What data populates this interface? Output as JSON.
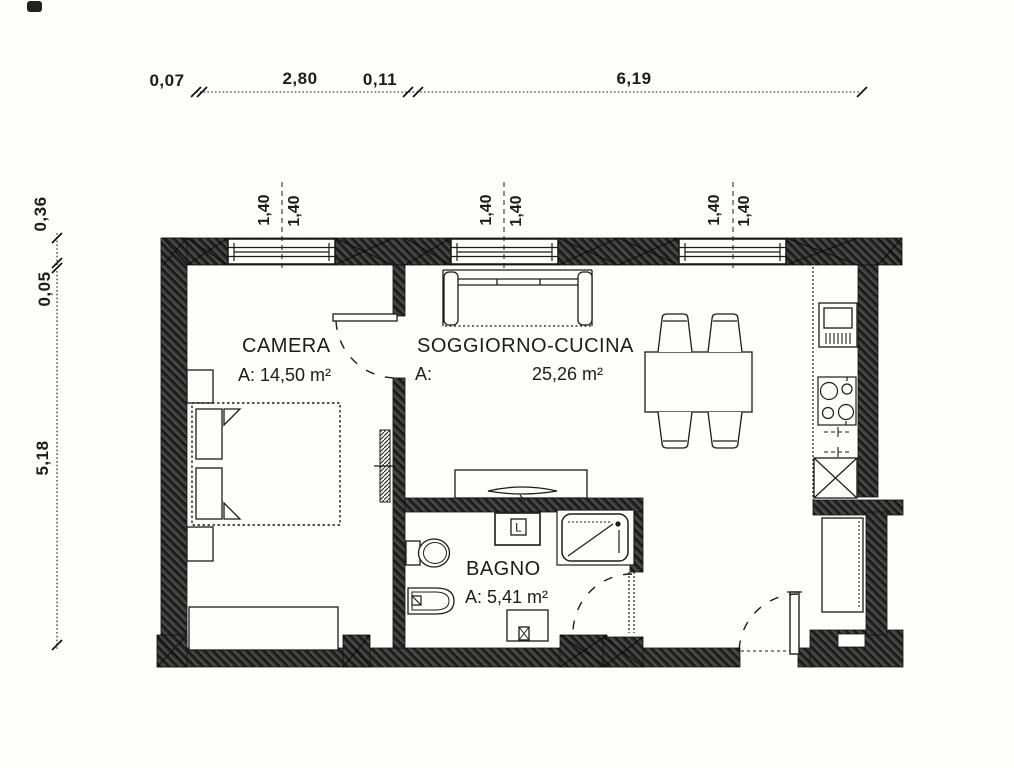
{
  "dims": {
    "top": {
      "d1": "0,07",
      "d2": "2,80",
      "d3": "0,11",
      "d4": "6,19"
    },
    "left": {
      "d1": "0,36",
      "d2": "0,05",
      "d3": "5,18"
    },
    "win1a": "1,40",
    "win1b": "1,40",
    "win2a": "1,40",
    "win2b": "1,40",
    "win3a": "1,40",
    "win3b": "1,40"
  },
  "rooms": {
    "camera": {
      "name": "CAMERA",
      "area": "A: 14,50 m²"
    },
    "soggiorno": {
      "name": "SOGGIORNO-CUCINA",
      "area_prefix": "A:",
      "area": "25,26 m²"
    },
    "bagno": {
      "name": "BAGNO",
      "area": "A: 5,41 m²"
    }
  },
  "fixtures": {
    "washing_machine_label": "L"
  }
}
